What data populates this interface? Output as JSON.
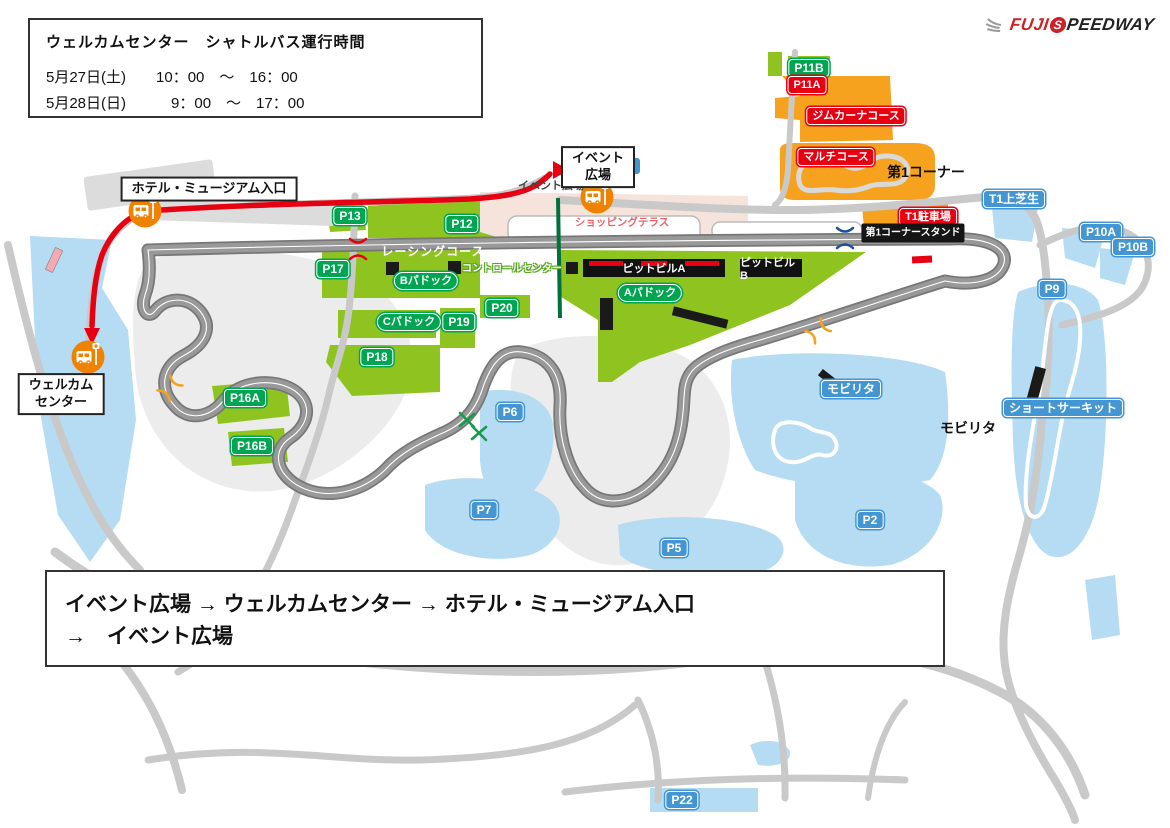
{
  "schedule_box": {
    "title": "ウェルカムセンター　シャトルバス運行時間",
    "lines": [
      "5月27日(土)　　10：00　～　16：00",
      "5月28日(日)　　　9：00　～　17：00"
    ]
  },
  "logo": {
    "part1": "FUJI",
    "s_letter": "S",
    "part2": "PEEDWAY"
  },
  "route_box": {
    "line1": "イベント広場 → ウェルカムセンター → ホテル・ミュージアム入口",
    "line2": "→　イベント広場"
  },
  "callouts": {
    "hotel_entrance": "ホテル・ミュージアム入口",
    "event_plaza": [
      "イベント",
      "広場"
    ],
    "welcome_center": [
      "ウェルカム",
      "センター"
    ]
  },
  "map_labels": {
    "p11b": "P11B",
    "p11a": "P11A",
    "gymkhana_course": "ジムカーナコース",
    "multi_course": "マルチコース",
    "first_corner": "第1コーナー",
    "t1_lawn": "T1上芝生",
    "t1_parking": "T1駐車場",
    "first_corner_stand": "第1コーナースタンド",
    "p10a": "P10A",
    "p10b": "P10B",
    "p9": "P9",
    "p13": "P13",
    "p12": "P12",
    "racing_course": "レーシングコース",
    "p17": "P17",
    "b_paddock": "Bパドック",
    "control_center": "コントロールセンター",
    "pit_building_a": "ピットビルA",
    "pit_building_b": "ピットビルB",
    "a_paddock": "Aパドック",
    "p20": "P20",
    "p19": "P19",
    "c_paddock": "Cパドック",
    "p18": "P18",
    "p16a": "P16A",
    "p16b": "P16B",
    "p6": "P6",
    "p7": "P7",
    "p5": "P5",
    "p2": "P2",
    "p22": "P22",
    "mobilitas_area": "モビリタ",
    "mobilitas_text": "モビリタ",
    "short_circuit": "ショートサーキット",
    "shopping_terrace": "ショッピングテラス",
    "event_plaza_area": "イベント広場"
  },
  "colors": {
    "route_red": "#e60012",
    "badge_green": "#00a551",
    "badge_blue": "#4496d3",
    "badge_red": "#e60012",
    "map_green": "#8fc31f",
    "map_blue": "#b5dcf2",
    "map_orange": "#f6a21e",
    "bus_stop_orange": "#ef8200"
  }
}
